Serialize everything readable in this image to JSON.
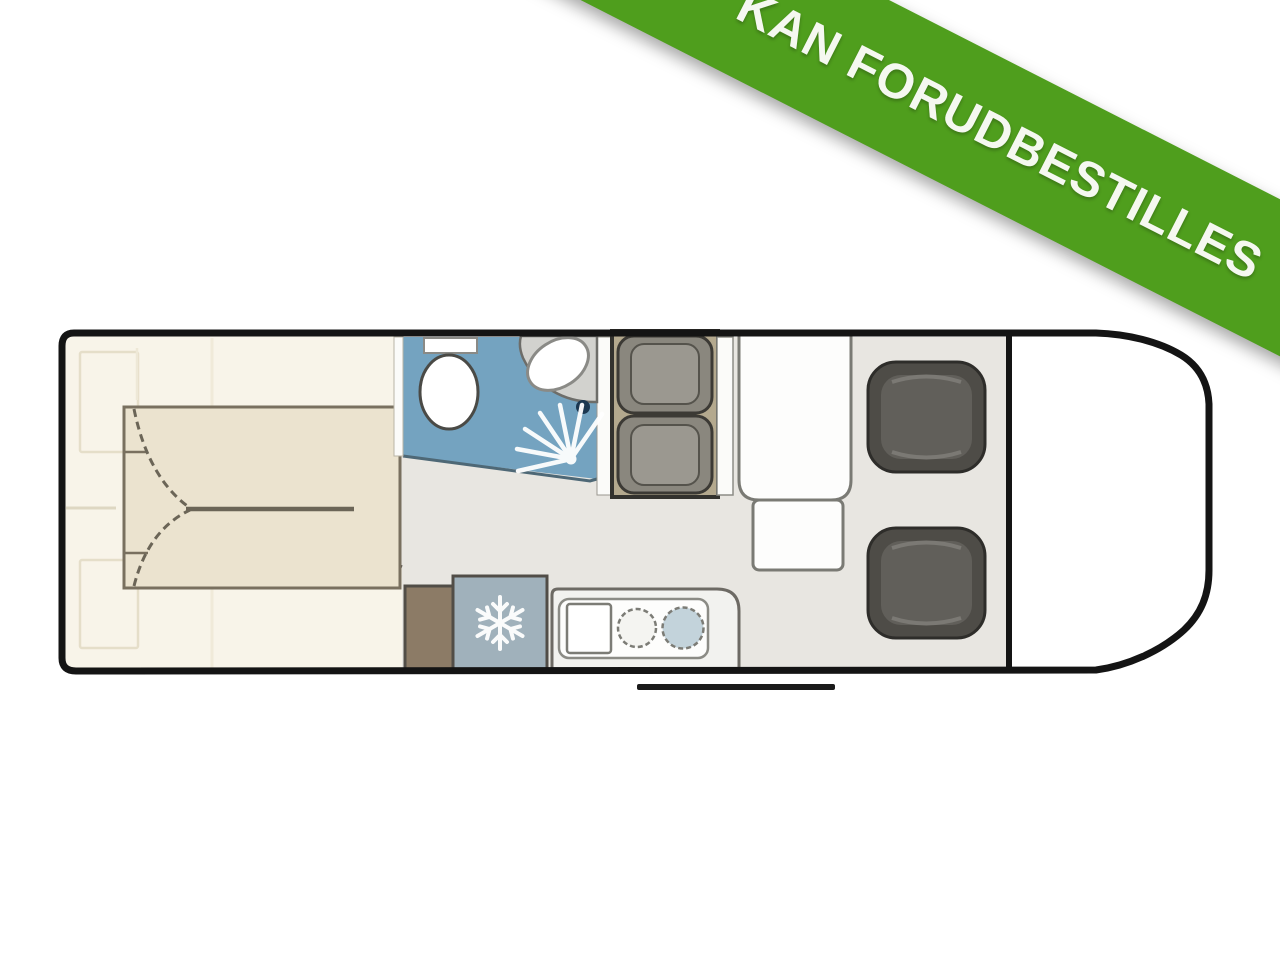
{
  "banner": {
    "label": "KAN FORUDBESTILLES",
    "background_color": "#4f9e1d",
    "text_color": "#f5f8f0"
  },
  "floorplan": {
    "type": "motorhome-floor-plan",
    "colors": {
      "outline": "#141414",
      "bedroom_floor": "#f8f4e9",
      "bed": "#ebe3cf",
      "bed_outline": "#79705f",
      "living_floor": "#e8e6e1",
      "bathroom_floor": "#74a3c0",
      "bathroom_edge": "#4e6876",
      "fixture_white": "#ffffff",
      "sink_rim": "#d2d2ce",
      "faucet_dark": "#1b3750",
      "wall_white": "#fbfbf9",
      "dinette_base": "#b4a98e",
      "seat_mid": "#8a877e",
      "seat_inner": "#9b9890",
      "chair": "#4e4c47",
      "chair_cushion": "#615f5a",
      "cabinet_brown": "#8c7b66",
      "fridge": "#a0b1bb",
      "counter": "#f2f2ef",
      "hob_blue": "#c3d3db",
      "step_black": "#1a1a1a"
    },
    "icons": {
      "fridge": "snowflake-icon",
      "shower": "spray-rays-icon"
    },
    "features": [
      {
        "name": "rear-bedroom-twin-beds"
      },
      {
        "name": "wardrobes"
      },
      {
        "name": "bathroom",
        "items": [
          "toilet",
          "corner-sink",
          "shower"
        ]
      },
      {
        "name": "dinette-double-seat"
      },
      {
        "name": "side-table-with-extension"
      },
      {
        "name": "kitchen",
        "items": [
          "cabinet",
          "fridge",
          "sink",
          "hob"
        ]
      },
      {
        "name": "cab",
        "items": [
          "driver-swivel-seat",
          "passenger-swivel-seat"
        ]
      },
      {
        "name": "entry-step"
      }
    ]
  }
}
